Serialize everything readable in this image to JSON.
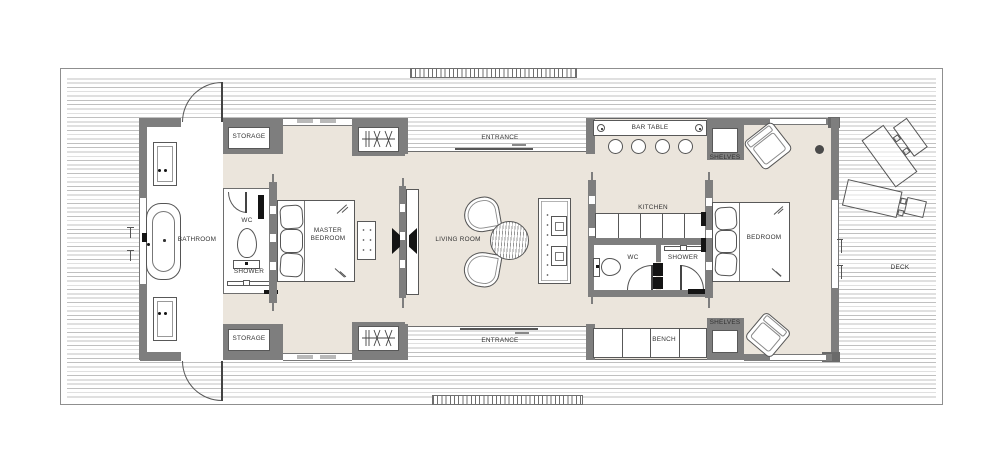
{
  "meta": {
    "type": "architectural-floor-plan",
    "view": "top-down plan of a long rectangular house with surrounding wood deck"
  },
  "colors": {
    "floor_beige": "#ebe5dc",
    "wall_gray": "#7e7e7e",
    "deck_line_gray": "#c0c0c0",
    "outline_gray": "#555555",
    "accent_black": "#141414",
    "paper_white": "#ffffff"
  },
  "labels": {
    "storage_top": "STORAGE",
    "storage_bottom": "STORAGE",
    "bathroom": "BATHROOM",
    "wc_master": "WC",
    "shower_master": "SHOWER",
    "master_bedroom": "MASTER BEDROOM",
    "living_room": "LIVING ROOM",
    "entrance_top": "ENTRANCE",
    "entrance_bottom": "ENTRANCE",
    "bar_table": "BAR TABLE",
    "kitchen": "KITCHEN",
    "wc_guest": "WC",
    "shower_guest": "SHOWER",
    "shelves_top": "SHELVES",
    "shelves_bottom": "SHELVES",
    "bench": "BENCH",
    "bedroom": "BEDROOM",
    "deck": "DECK"
  }
}
